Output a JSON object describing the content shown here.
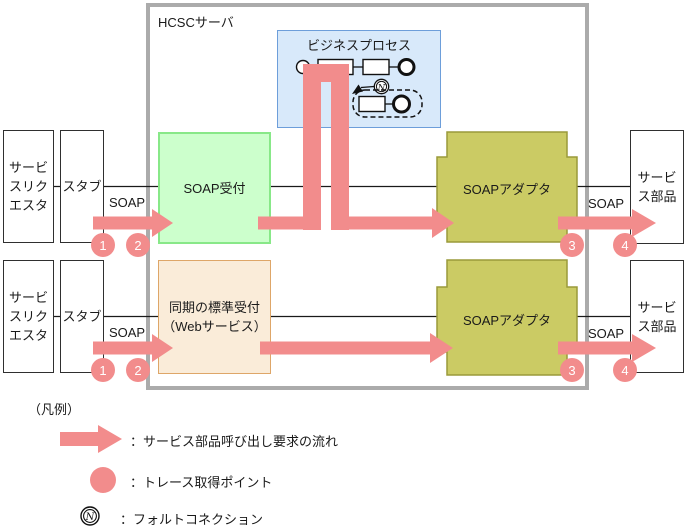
{
  "colors": {
    "pink": "#F28C8C",
    "green_fill": "#CCFFCC",
    "green_border": "#88E888",
    "blue_fill": "#D8E9FA",
    "blue_border": "#6D9EDA",
    "beige_fill": "#FAECD9",
    "beige_border": "#DEA668",
    "olive_fill": "#CBCB64",
    "olive_border": "#9A9A3A",
    "frame_gray": "#ABABAB",
    "ink": "#1A1A1A"
  },
  "server": {
    "label": "HCSCサーバ"
  },
  "business_process": {
    "title": "ビジネスプロセス",
    "fault_letter": "N"
  },
  "receptions": {
    "soap": "SOAP受付",
    "sync_line1": "同期の標準受付",
    "sync_line2": "（Webサービス）"
  },
  "adapter": {
    "label": "SOAPアダプタ"
  },
  "requester": {
    "line1": "サービ",
    "line2": "スリク",
    "line3": "エスタ"
  },
  "stub": {
    "label": "スタブ"
  },
  "service_part": {
    "line1": "サービ",
    "line2": "ス部品"
  },
  "protocol": {
    "label": "SOAP"
  },
  "trace_points": {
    "p1": "1",
    "p2": "2",
    "p3": "3",
    "p4": "4"
  },
  "legend": {
    "title": "（凡例）",
    "flow_label": "：サービス部品呼び出し要求の流れ",
    "trace_label": "：トレース取得ポイント",
    "fault_label": "：フォルトコネクション",
    "fault_letter": "N"
  }
}
